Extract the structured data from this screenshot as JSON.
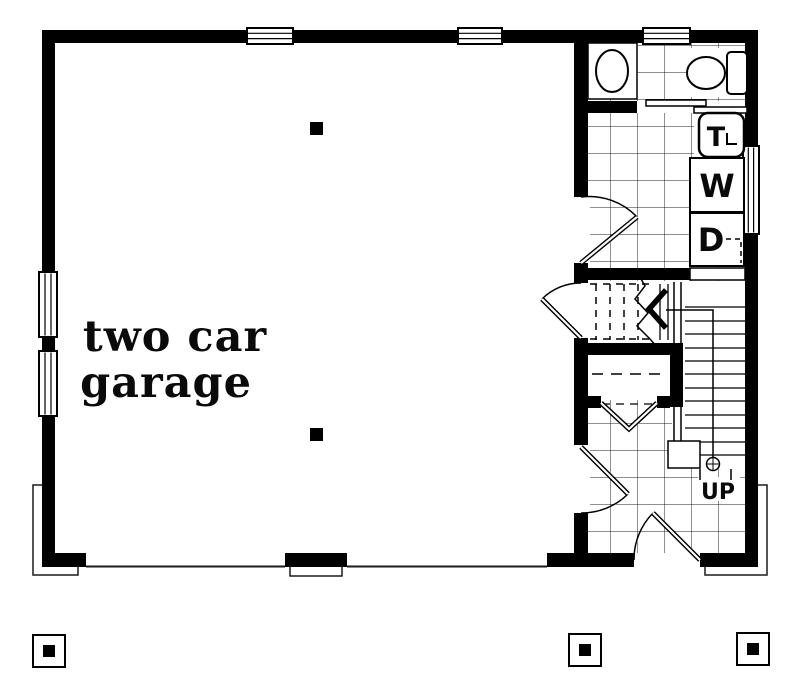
{
  "title": "Floor plan - two car garage",
  "labels": {
    "room_line1": "two car",
    "room_line2": "garage",
    "stairs_up": "UP",
    "washer": "W",
    "dryer": "D",
    "laundry_tray": "T"
  },
  "colors": {
    "wall": "#000000",
    "line": "#1a1a1a",
    "background": "#ffffff"
  }
}
